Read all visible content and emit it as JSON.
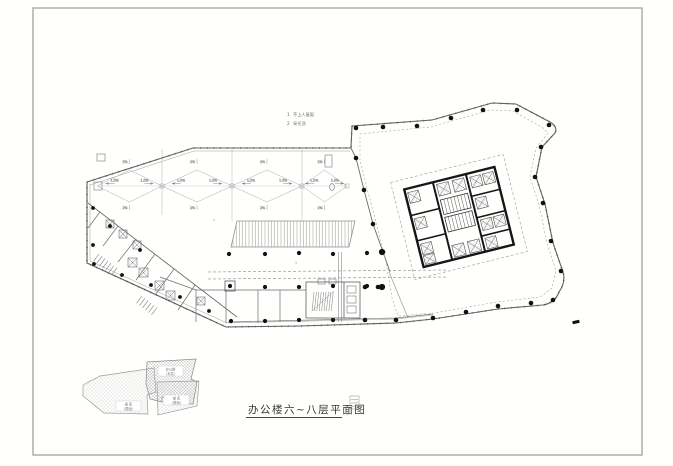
{
  "sheet": {
    "type": "architectural-floor-plan",
    "frame_color": "#a8a8a8",
    "paper_color": "#fffffe"
  },
  "title": {
    "text": "办公楼六~八层平面图"
  },
  "legend": {
    "items": [
      {
        "num": "1",
        "label": "不上人屋面"
      },
      {
        "num": "2",
        "label": "采光顶"
      }
    ]
  },
  "roof": {
    "gutter_slope": "1.5%",
    "panel_slope": "2%",
    "zone_marks": [
      "1",
      "1"
    ]
  },
  "keyplan": {
    "labels": [
      {
        "name": "办公楼",
        "area": "(本层)"
      },
      {
        "name": "裙 房",
        "area": "(屋面)"
      },
      {
        "name": "裙 房",
        "area": "(屋面)"
      }
    ]
  },
  "colors": {
    "outline": "#6a6a6a",
    "light_line": "#9a9a9a",
    "wall": "#1c1c1c",
    "column": "#111111",
    "hatch": "#b5b5b5"
  }
}
